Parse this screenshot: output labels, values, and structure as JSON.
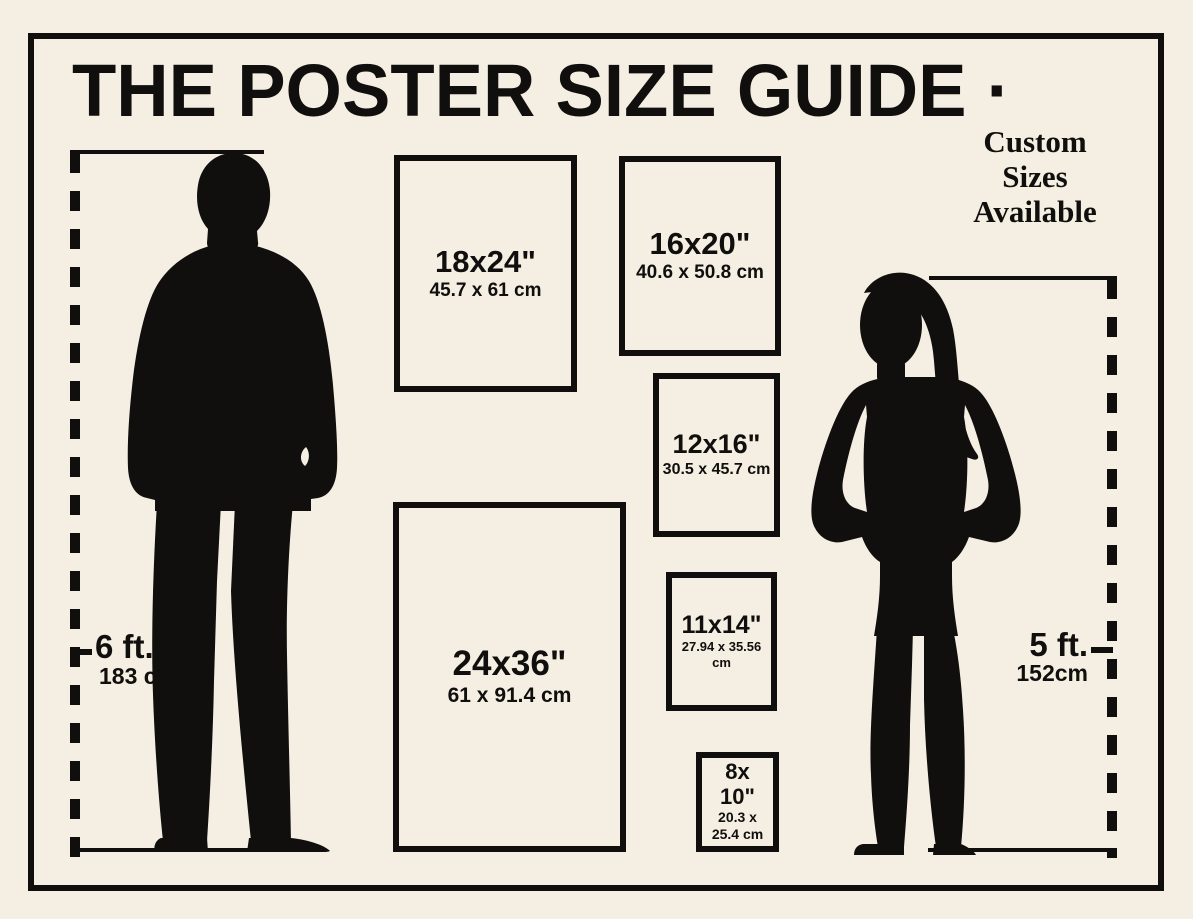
{
  "page": {
    "title": "THE POSTER SIZE GUIDE ·",
    "custom_note": "Custom\nSizes\nAvailable"
  },
  "posters": [
    {
      "id": "18x24",
      "size": "18x24\"",
      "metric": "45.7 x 61 cm"
    },
    {
      "id": "16x20",
      "size": "16x20\"",
      "metric": "40.6 x 50.8 cm"
    },
    {
      "id": "12x16",
      "size": "12x16\"",
      "metric": "30.5 x 45.7 cm"
    },
    {
      "id": "11x14",
      "size": "11x14\"",
      "metric": "27.94 x 35.56 cm"
    },
    {
      "id": "24x36",
      "size": "24x36\"",
      "metric": "61 x 91.4 cm"
    },
    {
      "id": "8x10",
      "size": "8x\n10\"",
      "metric": "20.3 x\n25.4 cm"
    }
  ],
  "figures": {
    "man": {
      "label_ft": "6 ft.",
      "label_cm": "183 cm"
    },
    "woman": {
      "label_ft": "5 ft.",
      "label_cm": "152cm"
    }
  },
  "colors": {
    "background": "#f4efe2",
    "ink": "#100f0d"
  }
}
